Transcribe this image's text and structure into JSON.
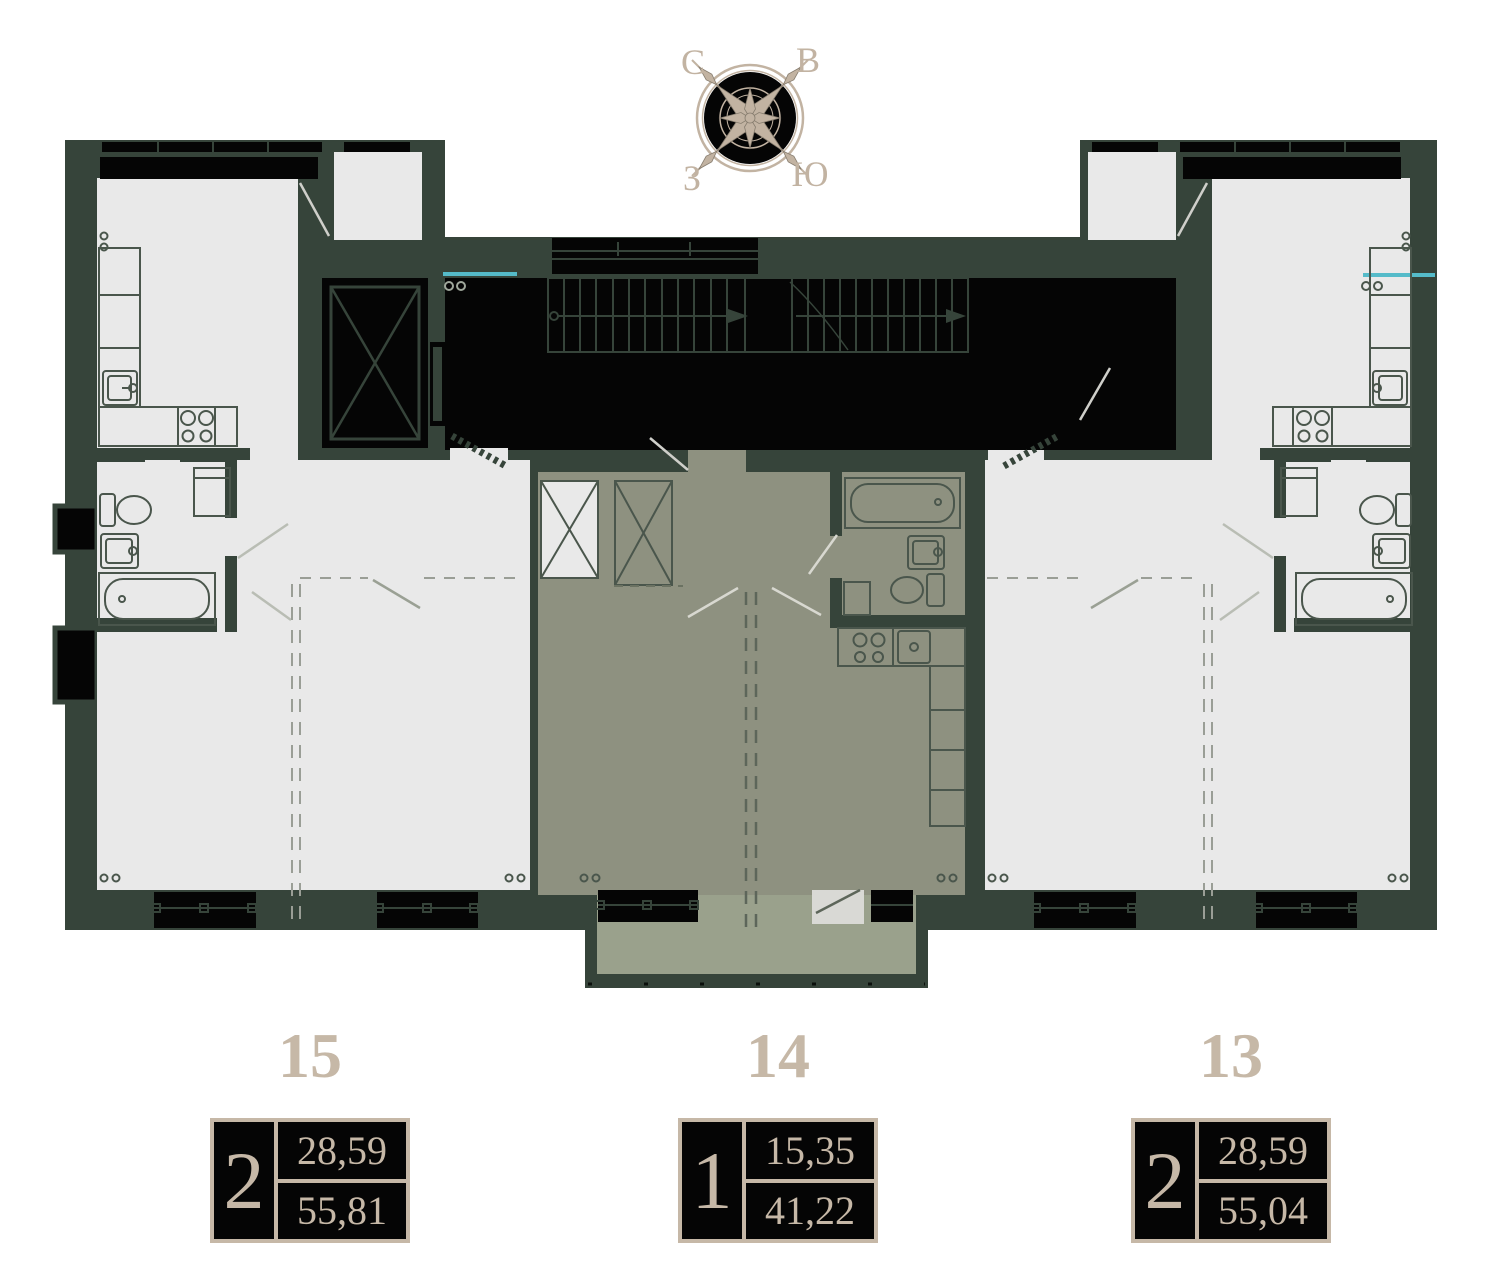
{
  "compass": {
    "north_label": "С",
    "east_label": "В",
    "west_label": "З",
    "south_label": "Ю"
  },
  "units": [
    {
      "plan_number": "15",
      "rooms": "2",
      "area_living": "28,59",
      "area_total": "55,81"
    },
    {
      "plan_number": "14",
      "rooms": "1",
      "area_living": "15,35",
      "area_total": "41,22"
    },
    {
      "plan_number": "13",
      "rooms": "2",
      "area_living": "28,59",
      "area_total": "55,04"
    }
  ],
  "colors": {
    "wall_green": "#36443a",
    "room_gray": "#e9e9e9",
    "apartment14_floor": "#8e9180",
    "balcony_floor": "#9aa18c",
    "core_black": "#050505",
    "accent_beige": "#c6b8a7",
    "teal_accent": "#55bbc9"
  }
}
